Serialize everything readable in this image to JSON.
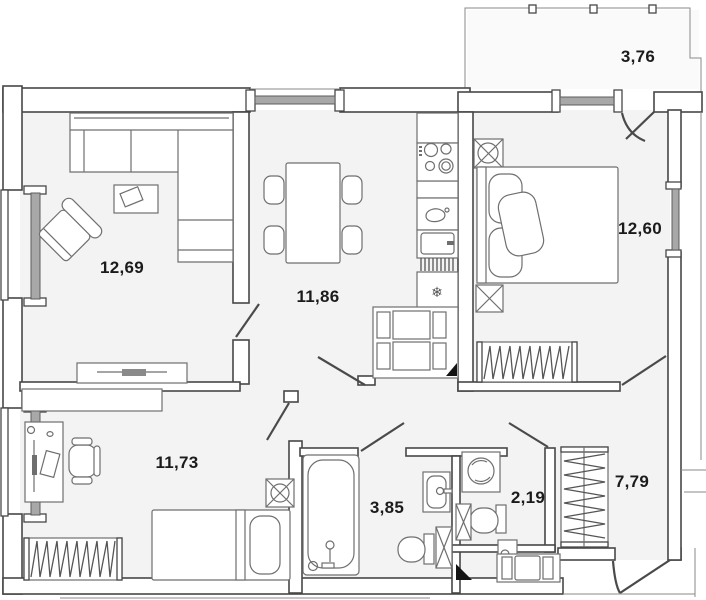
{
  "plan_title": "apartment-floor-plan",
  "rooms": [
    {
      "name": "living-room",
      "area": "12,69"
    },
    {
      "name": "kitchen",
      "area": "11,86"
    },
    {
      "name": "bedroom",
      "area": "12,60"
    },
    {
      "name": "balcony",
      "area": "3,76"
    },
    {
      "name": "second-room",
      "area": "11,73"
    },
    {
      "name": "bathroom",
      "area": "3,85"
    },
    {
      "name": "toilet",
      "area": "2,19"
    },
    {
      "name": "hallway",
      "area": "7,79"
    }
  ],
  "glyphs": {
    "snowflake": "❄"
  },
  "colors": {
    "wall_line": "#474747",
    "floor": "#f3f3f3",
    "furniture_line": "#6f6f6f",
    "window_glass": "#a8a8a8",
    "label_text": "#1b1b1b",
    "background": "#ffffff"
  }
}
